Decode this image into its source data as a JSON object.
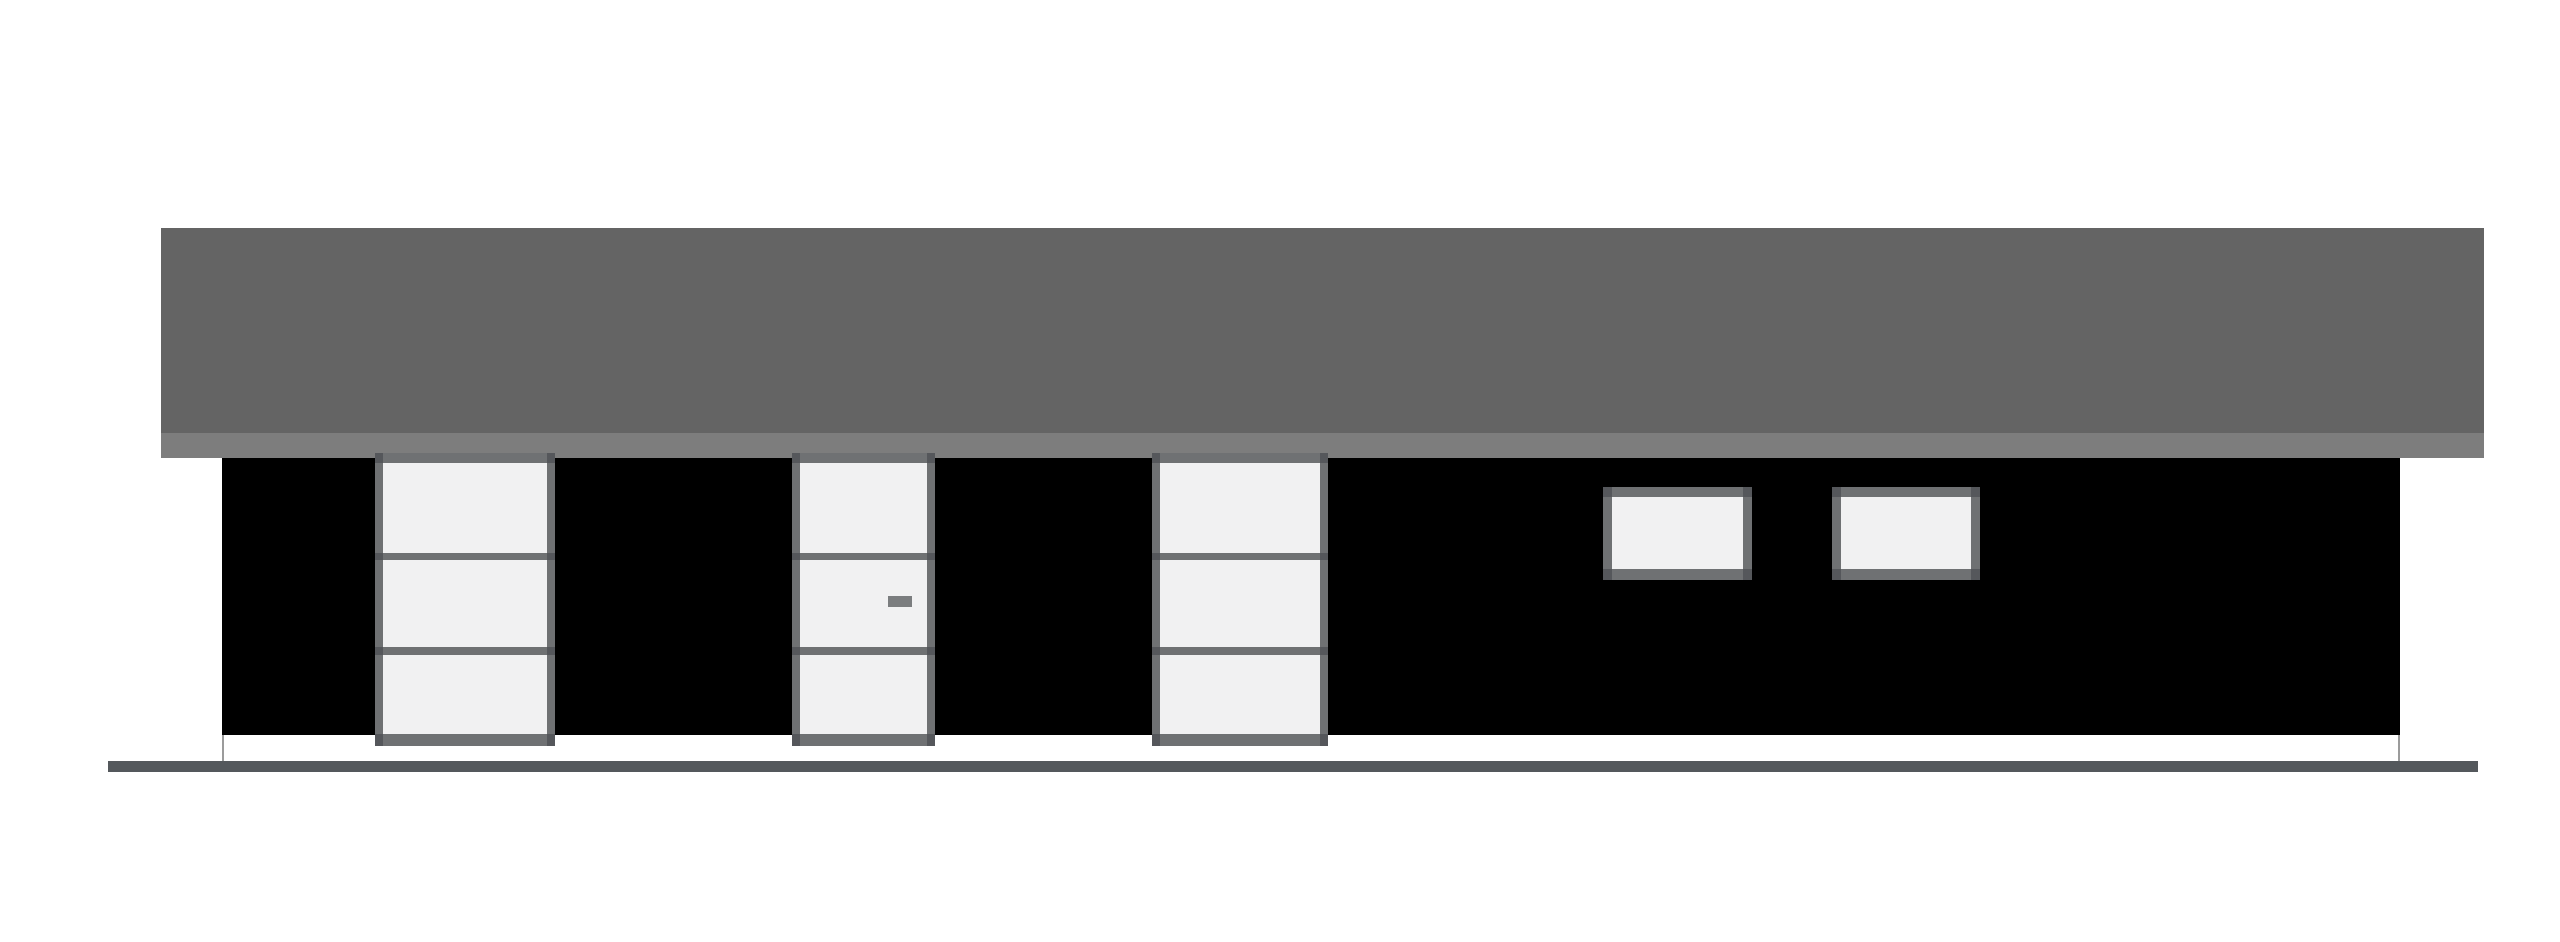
{
  "colors": {
    "background": "#ffffff",
    "roof": "#646464",
    "fascia": "#7d7d7d",
    "wall": "#000000",
    "frame": "#6f7173",
    "frame_cap": "#55575b",
    "pane": "#f1f1f2",
    "handle": "#7b7d7f",
    "ground": "#54585c",
    "foundation_outline": "#9b9b9b"
  },
  "elements": {
    "roof_main": {
      "x": 161,
      "y": 228,
      "w": 2323,
      "h": 205
    },
    "roof_fascia": {
      "x": 161,
      "y": 433,
      "w": 2323,
      "h": 25
    },
    "wall": {
      "x": 222,
      "y": 458,
      "w": 2178,
      "h": 277
    },
    "foundation": {
      "x": 222,
      "y": 735,
      "w": 2178,
      "h": 26
    },
    "ground_line": {
      "x": 108,
      "y": 761,
      "w": 2370,
      "h": 11
    },
    "tall_units": [
      {
        "name": "window-left",
        "x": 375,
        "y": 453,
        "w": 180,
        "h": 293,
        "panes": 3,
        "has_handle": false
      },
      {
        "name": "entry-door",
        "x": 792,
        "y": 453,
        "w": 143,
        "h": 293,
        "panes": 3,
        "has_handle": true
      },
      {
        "name": "window-middle",
        "x": 1152,
        "y": 453,
        "w": 176,
        "h": 293,
        "panes": 3,
        "has_handle": false
      }
    ],
    "door_handle": {
      "x": 96,
      "y": 143,
      "w": 24,
      "h": 11
    },
    "small_windows": [
      {
        "name": "small-window-left",
        "x": 1603,
        "y": 487,
        "w": 149,
        "h": 93
      },
      {
        "name": "small-window-right",
        "x": 1832,
        "y": 487,
        "w": 148,
        "h": 93
      }
    ]
  }
}
